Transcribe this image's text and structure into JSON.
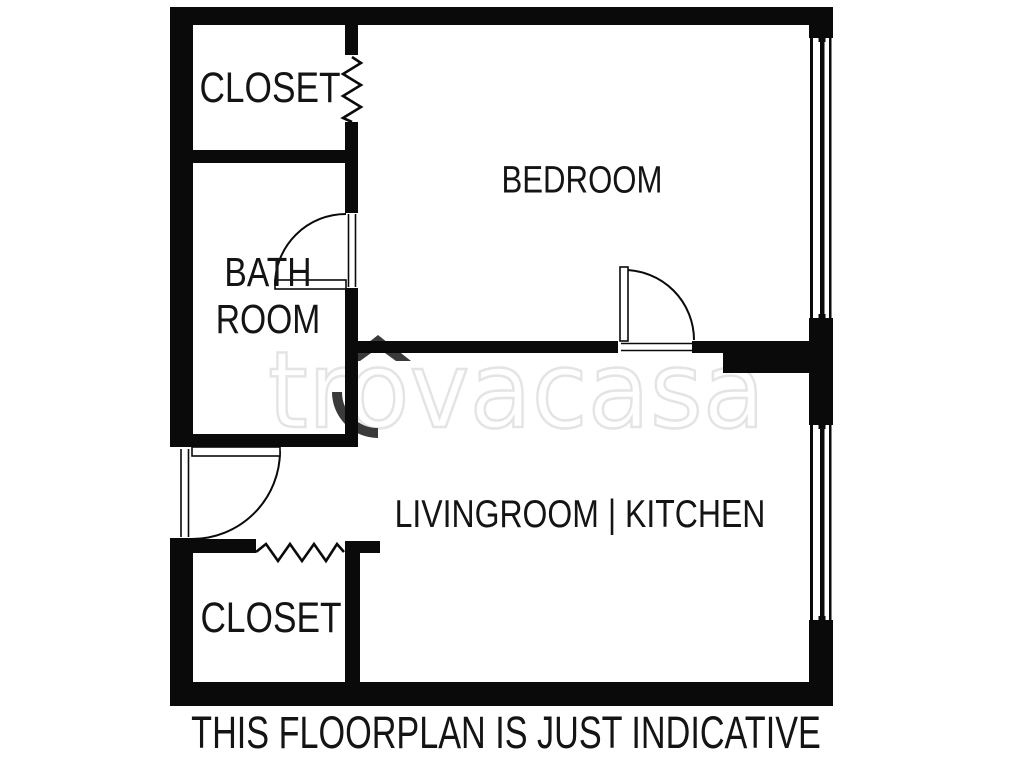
{
  "plan": {
    "rooms": [
      {
        "id": "closet-top",
        "label": "CLOSET"
      },
      {
        "id": "bedroom",
        "label": "BEDROOM"
      },
      {
        "id": "bathroom",
        "label_line1": "BATH",
        "label_line2": "ROOM"
      },
      {
        "id": "livingroom-kitchen",
        "label": "LIVINGROOM | KITCHEN"
      },
      {
        "id": "closet-bottom",
        "label": "CLOSET"
      }
    ],
    "features": [
      "entrance-door",
      "bathroom-door",
      "bedroom-door",
      "accordion-door-top-closet",
      "accordion-door-bottom-closet",
      "window-bedroom",
      "window-livingroom"
    ]
  },
  "watermark": {
    "text": "trovacasa"
  },
  "caption": {
    "text": "THIS FLOORPLAN IS JUST INDICATIVE"
  },
  "colors": {
    "wall": "#0a0a0a",
    "background": "#ffffff",
    "label_text": "#141414",
    "watermark_outline": "#e4e4e4",
    "watermark_roof": "#3a3a3a"
  }
}
